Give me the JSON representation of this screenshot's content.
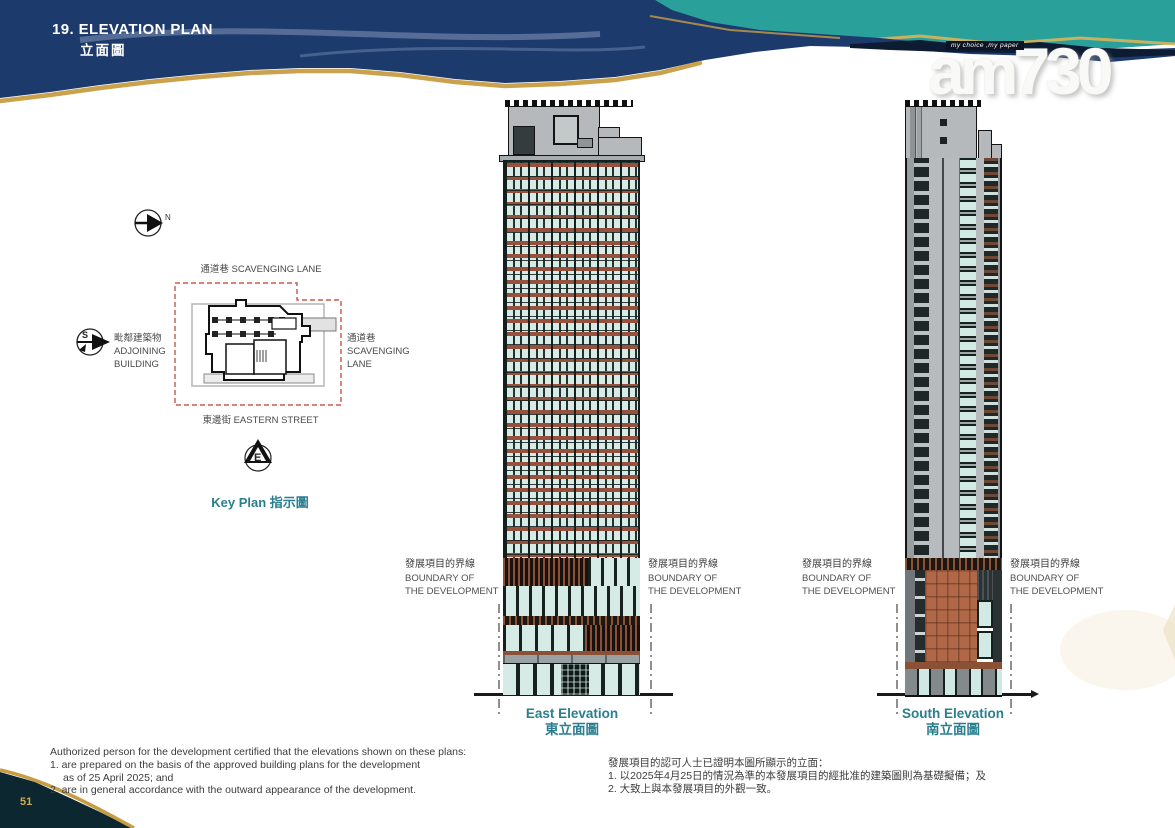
{
  "page": {
    "number": "51"
  },
  "header": {
    "section_title": "19. ELEVATION PLAN",
    "section_title_zh": "立面圖"
  },
  "masthead": {
    "tagline": "my choice ,my paper",
    "logo_text": "am730"
  },
  "compass": {
    "north": "N",
    "south": "S",
    "east": "E"
  },
  "key_plan": {
    "label_top": "通道巷 SCAVENGING LANE",
    "label_left_zh": "毗鄰建築物",
    "label_left_en1": "ADJOINING",
    "label_left_en2": "BUILDING",
    "label_right_zh": "通道巷",
    "label_right_en1": "SCAVENGING",
    "label_right_en2": "LANE",
    "label_bottom": "東邊街 EASTERN STREET",
    "caption": "Key Plan 指示圖"
  },
  "boundary_label": {
    "zh": "發展項目的界線",
    "en1": "BOUNDARY OF",
    "en2": "THE DEVELOPMENT"
  },
  "elevations": {
    "east": {
      "caption_en": "East Elevation",
      "caption_zh": "東立面圖"
    },
    "south": {
      "caption_en": "South Elevation",
      "caption_zh": "南立面圖"
    }
  },
  "notes_en": {
    "intro": "Authorized person for the development certified that the elevations shown on these plans:",
    "item1": "1. are prepared on the basis of the approved building plans for the development",
    "item1b": "as of 25 April 2025; and",
    "item2": "2. are in general accordance with the outward appearance of the development."
  },
  "notes_zh": {
    "intro": "發展項目的認可人士已證明本圖所顯示的立面：",
    "item1": "1. 以2025年4月25日的情況為準的本發展項目的經批准的建築圖則為基礎擬備；及",
    "item2": "2. 大致上與本發展項目的外觀一致。"
  },
  "colors": {
    "banner_navy": "#1d3a6d",
    "banner_teal": "#2aa09b",
    "gold_edge": "#c79d43",
    "heading_teal": "#2a7e8e",
    "boundary_red": "#c0392b",
    "glass_mint": "#d7ebe6",
    "spandrel_brown": "#96503c",
    "podium_terracotta": "#b06848",
    "corner_dark": "#0c2730"
  }
}
